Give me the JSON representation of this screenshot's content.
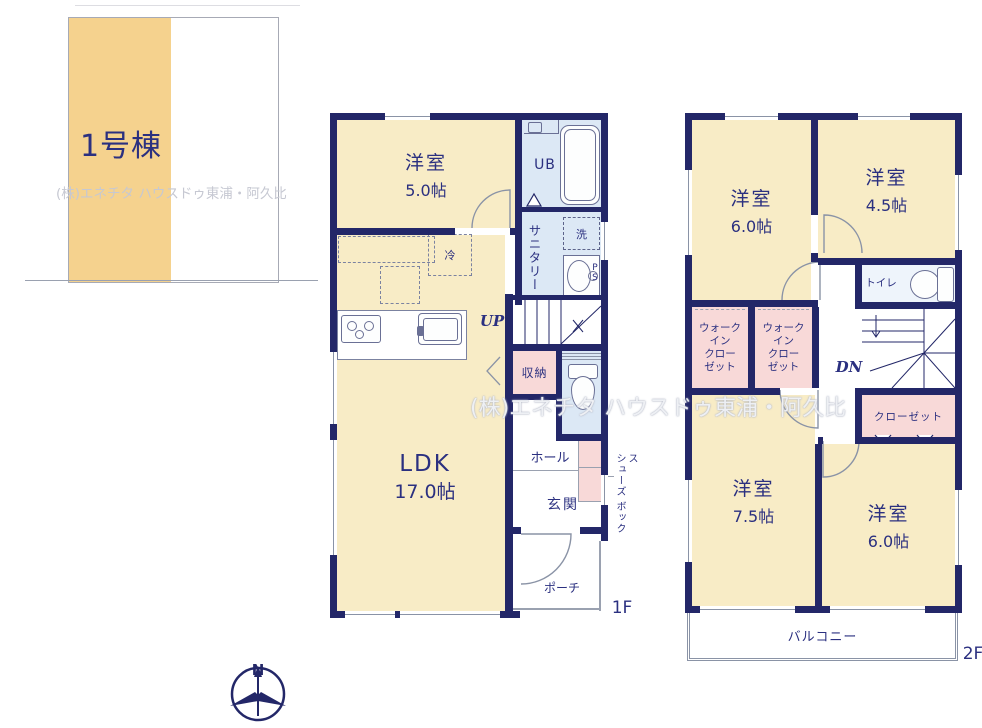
{
  "site_plan": {
    "building_label": "1号棟"
  },
  "watermark": "(株)エネチタ ハウスドゥ東浦・阿久比",
  "floor1": {
    "floor_label": "1F",
    "room5": {
      "name": "洋室",
      "size": "5.0帖"
    },
    "ldk": {
      "name": "LDK",
      "size": "17.0帖"
    },
    "ub": "UB",
    "sanitary": "サニタリー",
    "washer": "洗",
    "fridge": "冷",
    "up": "UP",
    "storage": "収納",
    "hall": "ホール",
    "entrance": "玄関",
    "porch": "ポーチ",
    "shoebox_line1": "シューズ",
    "shoebox_line2": "ボックス",
    "pipe_space": "P\nS"
  },
  "floor2": {
    "floor_label": "2F",
    "room_nw": {
      "name": "洋室",
      "size": "6.0帖"
    },
    "room_ne": {
      "name": "洋室",
      "size": "4.5帖"
    },
    "toilet": "トイレ",
    "down": "DN",
    "wic": "ウォーク\nイン\nクロー\nゼット",
    "closet": "クローゼット",
    "room_sw": {
      "name": "洋室",
      "size": "7.5帖"
    },
    "room_se": {
      "name": "洋室",
      "size": "6.0帖"
    },
    "balcony": "バルコニー"
  },
  "compass": {
    "north": "N"
  },
  "colors": {
    "wall_navy": "#232768",
    "room_cream": "#f8ecc6",
    "closet_pink": "#f8d9d8",
    "bath_blue": "#dce8f5",
    "plot_orange": "#f5d28e",
    "text_ink": "#2b3080"
  }
}
